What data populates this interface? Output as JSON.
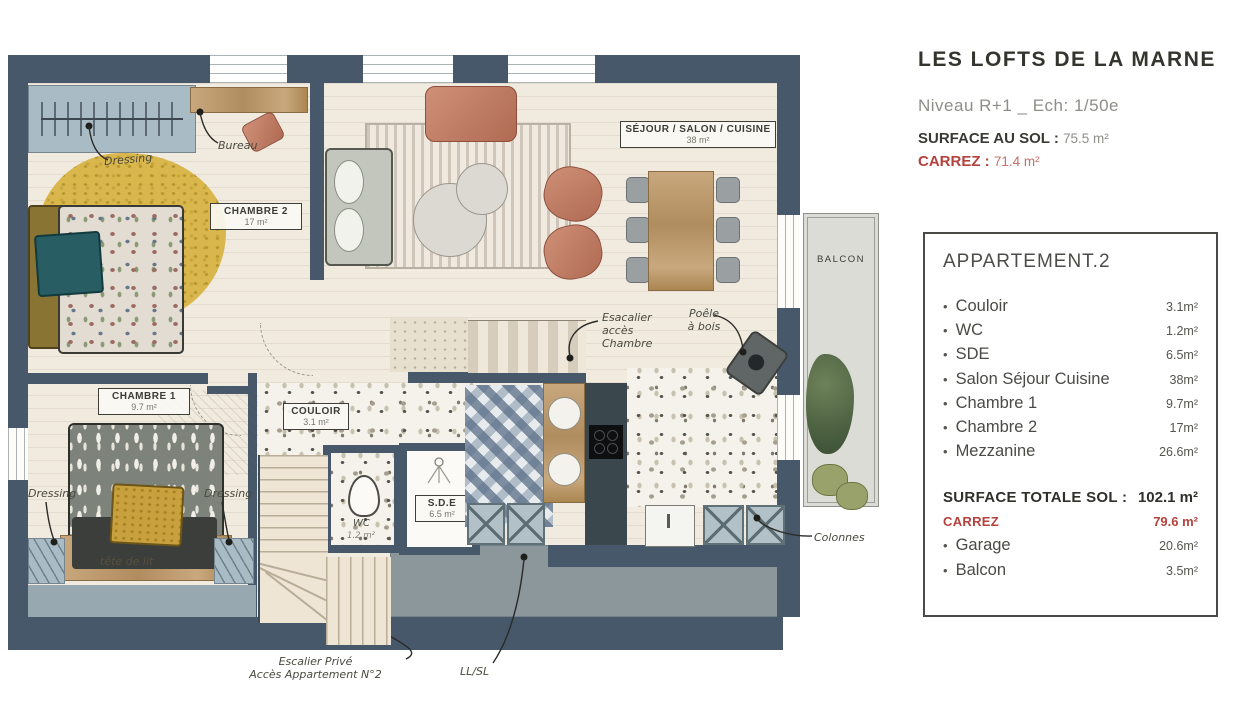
{
  "header": {
    "title": "LES LOFTS DE LA MARNE",
    "subtitle": "Niveau R+1 _ Ech: 1/50e",
    "surface_label": "SURFACE AU SOL :",
    "surface_value": "75.5 m²",
    "carrez_label": "CARREZ :",
    "carrez_value": "71.4 m²"
  },
  "panel": {
    "title": "APPARTEMENT.2",
    "rooms": [
      {
        "label": "Couloir",
        "value": "3.1m²"
      },
      {
        "label": "WC",
        "value": "1.2m²"
      },
      {
        "label": "SDE",
        "value": "6.5m²"
      },
      {
        "label": "Salon Séjour Cuisine",
        "value": "38m²"
      },
      {
        "label": "Chambre 1",
        "value": "9.7m²"
      },
      {
        "label": "Chambre 2",
        "value": "17m²"
      },
      {
        "label": "Mezzanine",
        "value": "26.6m²"
      }
    ],
    "total_label": "SURFACE TOTALE SOL :",
    "total_value": "102.1 m²",
    "carrez_label": "CARREZ",
    "carrez_value": "79.6 m²",
    "extras": [
      {
        "label": "Garage",
        "value": "20.6m²"
      },
      {
        "label": "Balcon",
        "value": "3.5m²"
      }
    ]
  },
  "plan": {
    "rooms": {
      "sejour": {
        "name": "SÉJOUR / SALON / CUISINE",
        "area": "38 m²"
      },
      "chambre2": {
        "name": "CHAMBRE 2",
        "area": "17 m²"
      },
      "chambre1": {
        "name": "CHAMBRE 1",
        "area": "9.7 m²"
      },
      "couloir": {
        "name": "COULOIR",
        "area": "3.1 m²"
      },
      "sde": {
        "name": "S.D.E",
        "area": "6.5 m²"
      },
      "wc": {
        "name": "WC",
        "area": "1.2 m²"
      },
      "balcon": {
        "name": "BALCON"
      }
    },
    "annotations": {
      "dressing_ch2": "Dressing",
      "bureau": "Bureau",
      "escalier_chambre": [
        "Esacalier",
        "accès",
        "Chambre"
      ],
      "poele": [
        "Poêle",
        "à bois"
      ],
      "dressing_left": "Dressing",
      "dressing_right": "Dressing",
      "tete_de_lit": "tête de lit",
      "colonnes": "Colonnes",
      "escalier_prive": [
        "Escalier Privé",
        "Accès Appartement N°2"
      ],
      "llsl": "LL/SL"
    },
    "colors": {
      "wall": "#46586a",
      "floor": "#f1eadf",
      "accent_red": "#b5413c",
      "terracotta": "#bf7e66",
      "mustard": "#d9b74d",
      "teal": "#2e6066",
      "blue_gray": "#a9bcc6",
      "slab_gray": "#8c979b",
      "balcony_gray": "#dcdcd6"
    }
  }
}
